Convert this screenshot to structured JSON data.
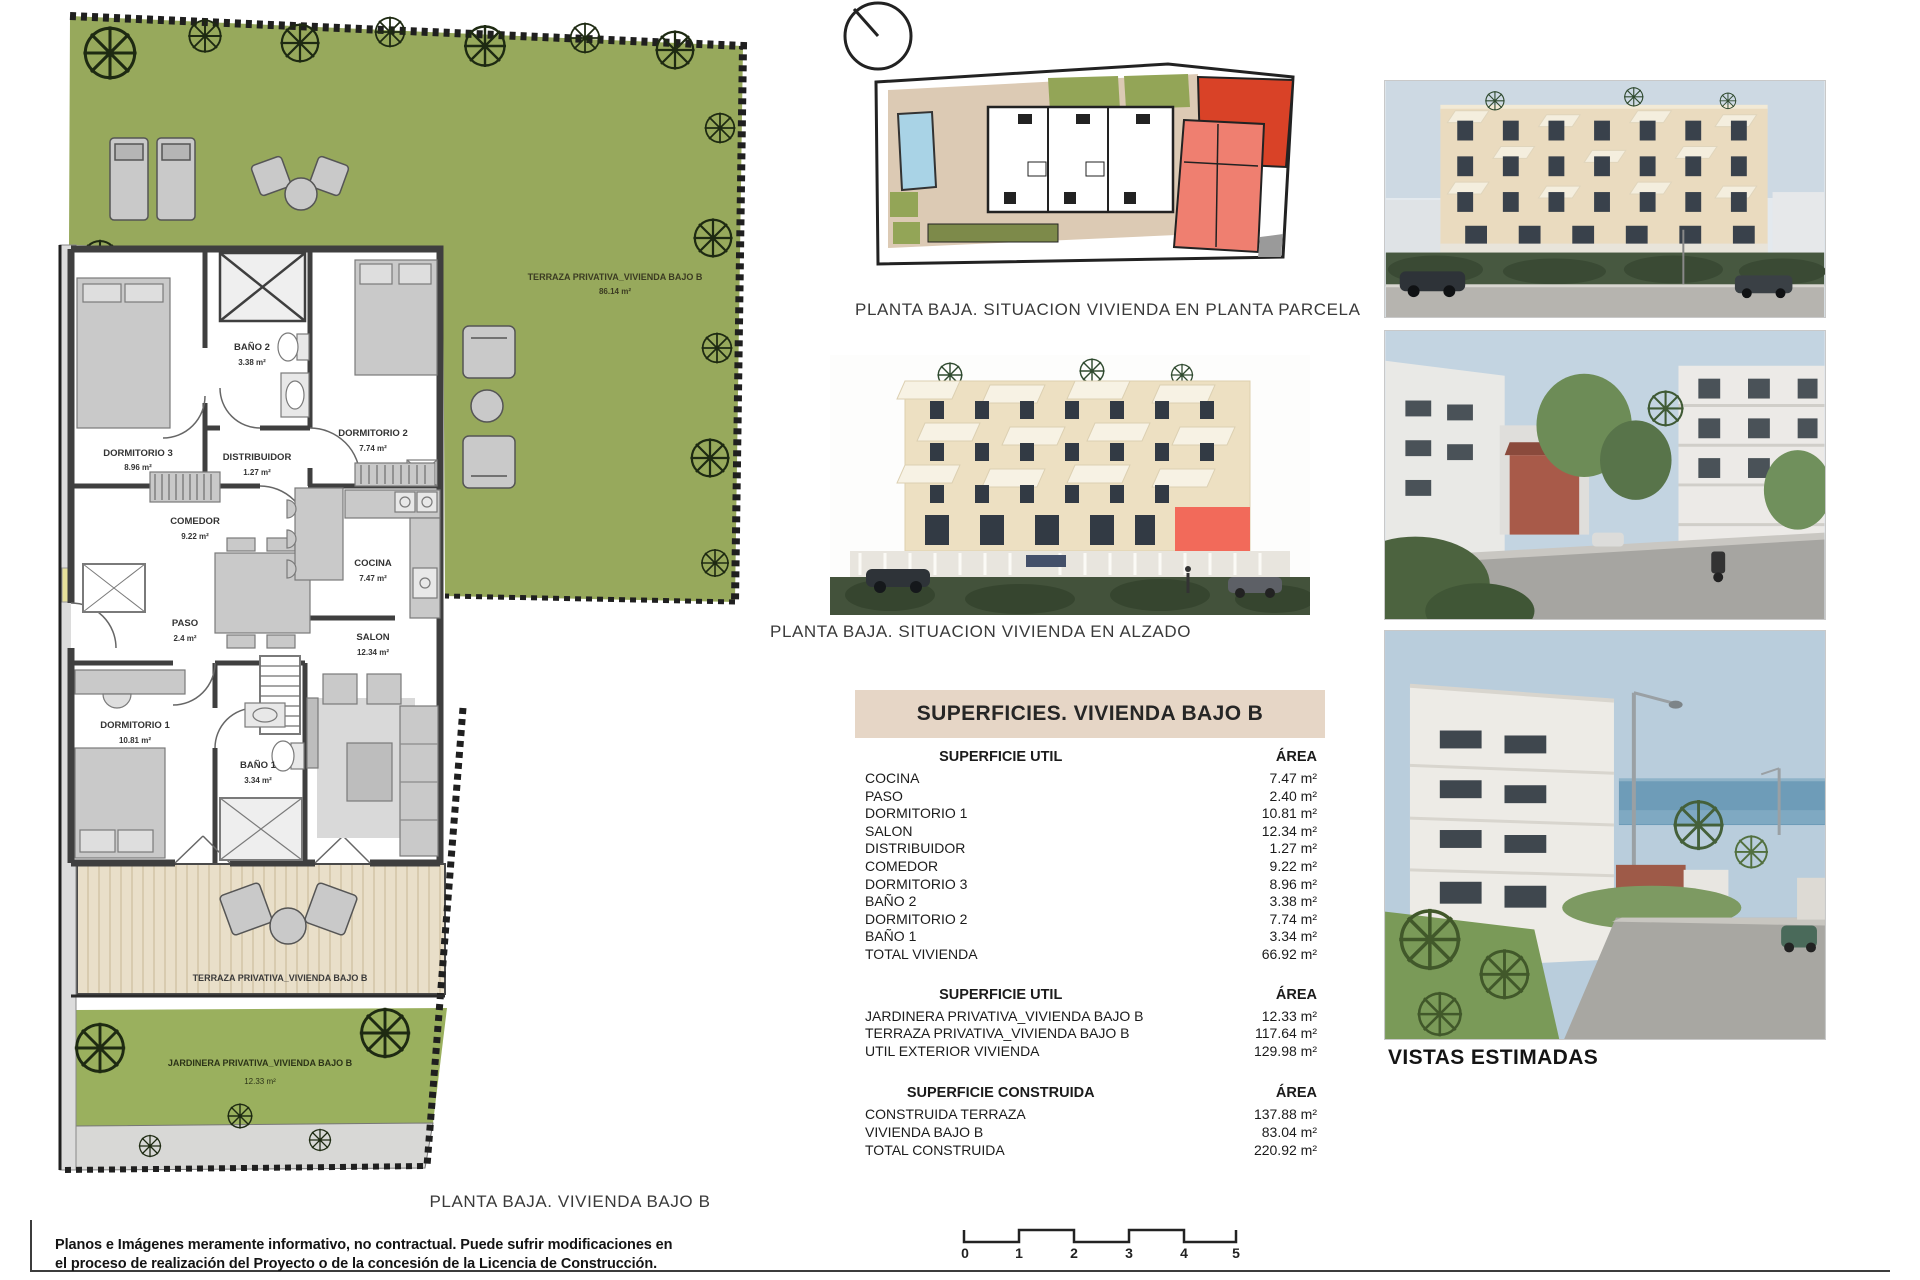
{
  "floor_plan": {
    "caption": "PLANTA BAJA. VIVIENDA BAJO B",
    "rooms": [
      {
        "name": "DORMITORIO 3",
        "area": "8.96 m²"
      },
      {
        "name": "BAÑO 2",
        "area": "3.38 m²"
      },
      {
        "name": "DISTRIBUIDOR",
        "area": "1.27 m²"
      },
      {
        "name": "DORMITORIO 2",
        "area": "7.74 m²"
      },
      {
        "name": "COMEDOR",
        "area": "9.22 m²"
      },
      {
        "name": "COCINA",
        "area": "7.47 m²"
      },
      {
        "name": "PASO",
        "area": "2.4 m²"
      },
      {
        "name": "SALON",
        "area": "12.34 m²"
      },
      {
        "name": "DORMITORIO 1",
        "area": "10.81 m²"
      },
      {
        "name": "BAÑO 1",
        "area": "3.34 m²"
      }
    ],
    "terraza_top": {
      "label": "TERRAZA PRIVATIVA_VIVIENDA BAJO B",
      "area": "86.14 m²"
    },
    "terraza_bottom": {
      "label": "TERRAZA PRIVATIVA_VIVIENDA BAJO B"
    },
    "jardinera": {
      "label": "JARDINERA PRIVATIVA_VIVIENDA BAJO B",
      "area": "12.33 m²"
    }
  },
  "site_plan": {
    "caption": "PLANTA BAJA. SITUACION VIVIENDA EN PLANTA PARCELA"
  },
  "elevation": {
    "caption": "PLANTA BAJA. SITUACION VIVIENDA EN ALZADO"
  },
  "surfaces_table": {
    "title": "SUPERFICIES. VIVIENDA BAJO B",
    "sections": [
      {
        "header": "SUPERFICIE UTIL",
        "area_header": "ÁREA",
        "rows": [
          [
            "COCINA",
            "7.47 m²"
          ],
          [
            "PASO",
            "2.40 m²"
          ],
          [
            "DORMITORIO 1",
            "10.81 m²"
          ],
          [
            "SALON",
            "12.34 m²"
          ],
          [
            "DISTRIBUIDOR",
            "1.27 m²"
          ],
          [
            "COMEDOR",
            "9.22 m²"
          ],
          [
            "DORMITORIO 3",
            "8.96 m²"
          ],
          [
            "BAÑO 2",
            "3.38 m²"
          ],
          [
            "DORMITORIO 2",
            "7.74 m²"
          ],
          [
            "BAÑO 1",
            "3.34 m²"
          ],
          [
            "TOTAL VIVIENDA",
            "66.92 m²"
          ]
        ]
      },
      {
        "header": "SUPERFICIE UTIL",
        "area_header": "ÁREA",
        "rows": [
          [
            "JARDINERA PRIVATIVA_VIVIENDA BAJO B",
            "12.33 m²"
          ],
          [
            "TERRAZA PRIVATIVA_VIVIENDA BAJO B",
            "117.64 m²"
          ],
          [
            "UTIL EXTERIOR VIVIENDA",
            "129.98 m²"
          ]
        ]
      },
      {
        "header": "SUPERFICIE CONSTRUIDA",
        "area_header": "ÁREA",
        "rows": [
          [
            "CONSTRUIDA TERRAZA",
            "137.88 m²"
          ],
          [
            "VIVIENDA BAJO B",
            "83.04 m²"
          ],
          [
            "TOTAL CONSTRUIDA",
            "220.92 m²"
          ]
        ]
      }
    ]
  },
  "photos": {
    "caption": "VISTAS ESTIMADAS"
  },
  "scale_bar": {
    "ticks": [
      "0",
      "1",
      "2",
      "3",
      "4",
      "5"
    ]
  },
  "disclaimer": {
    "line1": "Planos e Imágenes meramente informativo, no contractual. Puede sufrir modificaciones en",
    "line2": "el proceso de realización del Proyecto o de la concesión de la Licencia de Construcción."
  }
}
